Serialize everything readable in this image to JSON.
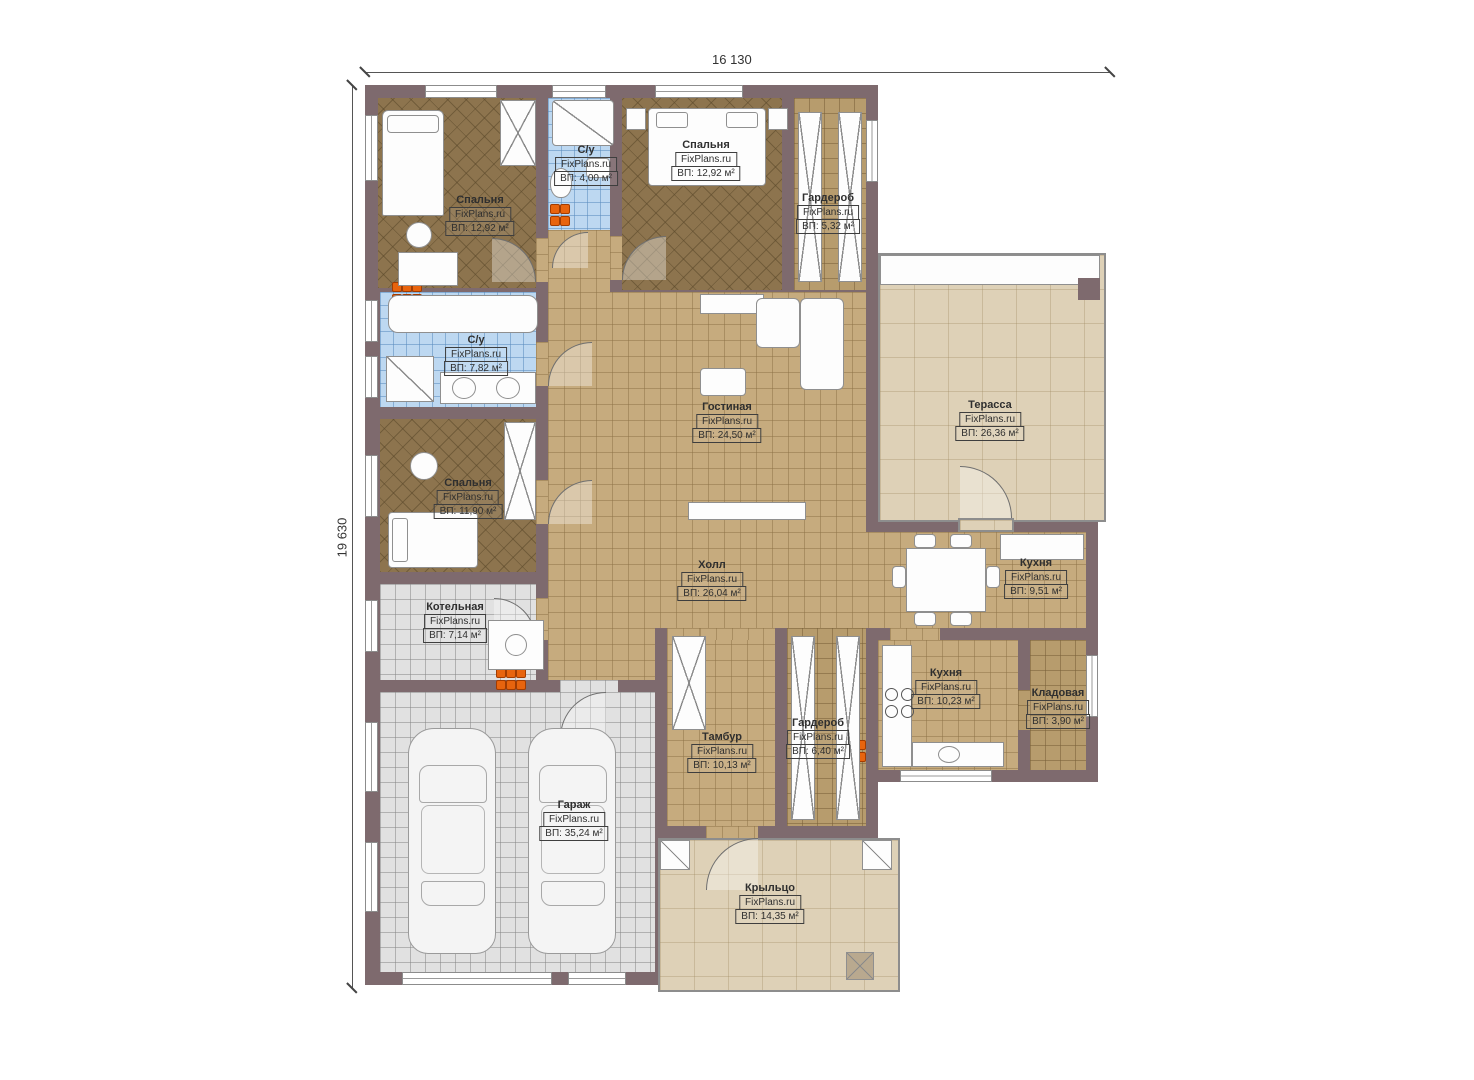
{
  "brand": "FixPlans.ru",
  "dimensions": {
    "width": "16 130",
    "height": "19 630"
  },
  "rooms": [
    {
      "name": "Спальня",
      "area": "ВП: 12,92 м²"
    },
    {
      "name": "С/у",
      "area": "ВП: 4,00 м²"
    },
    {
      "name": "Спальня",
      "area": "ВП: 12,92 м²"
    },
    {
      "name": "Гардероб",
      "area": "ВП: 5,32 м²"
    },
    {
      "name": "Терасса",
      "area": "ВП: 26,36 м²"
    },
    {
      "name": "С/у",
      "area": "ВП: 7,82 м²"
    },
    {
      "name": "Гостиная",
      "area": "ВП: 24,50 м²"
    },
    {
      "name": "Спальня",
      "area": "ВП: 11,90 м²"
    },
    {
      "name": "Холл",
      "area": "ВП: 26,04 м²"
    },
    {
      "name": "Кухня",
      "area": "ВП: 9,51 м²"
    },
    {
      "name": "Котельная",
      "area": "ВП: 7,14 м²"
    },
    {
      "name": "Кухня",
      "area": "ВП: 10,23 м²"
    },
    {
      "name": "Кладовая",
      "area": "ВП: 3,90 м²"
    },
    {
      "name": "Тамбур",
      "area": "ВП: 10,13 м²"
    },
    {
      "name": "Гардероб",
      "area": "ВП: 6,40 м²"
    },
    {
      "name": "Гараж",
      "area": "ВП: 35,24 м²"
    },
    {
      "name": "Крыльцо",
      "area": "ВП: 14,35 м²"
    }
  ],
  "colors": {
    "wall": "#7e6a6e",
    "floor_tan": "#c6ab7e",
    "floor_brown": "#8d744e",
    "tile_blue": "#bdd8f1",
    "tile_gray": "#e1e1e1",
    "deck_beige": "#ded1b7",
    "heater_orange": "#e8640e"
  }
}
